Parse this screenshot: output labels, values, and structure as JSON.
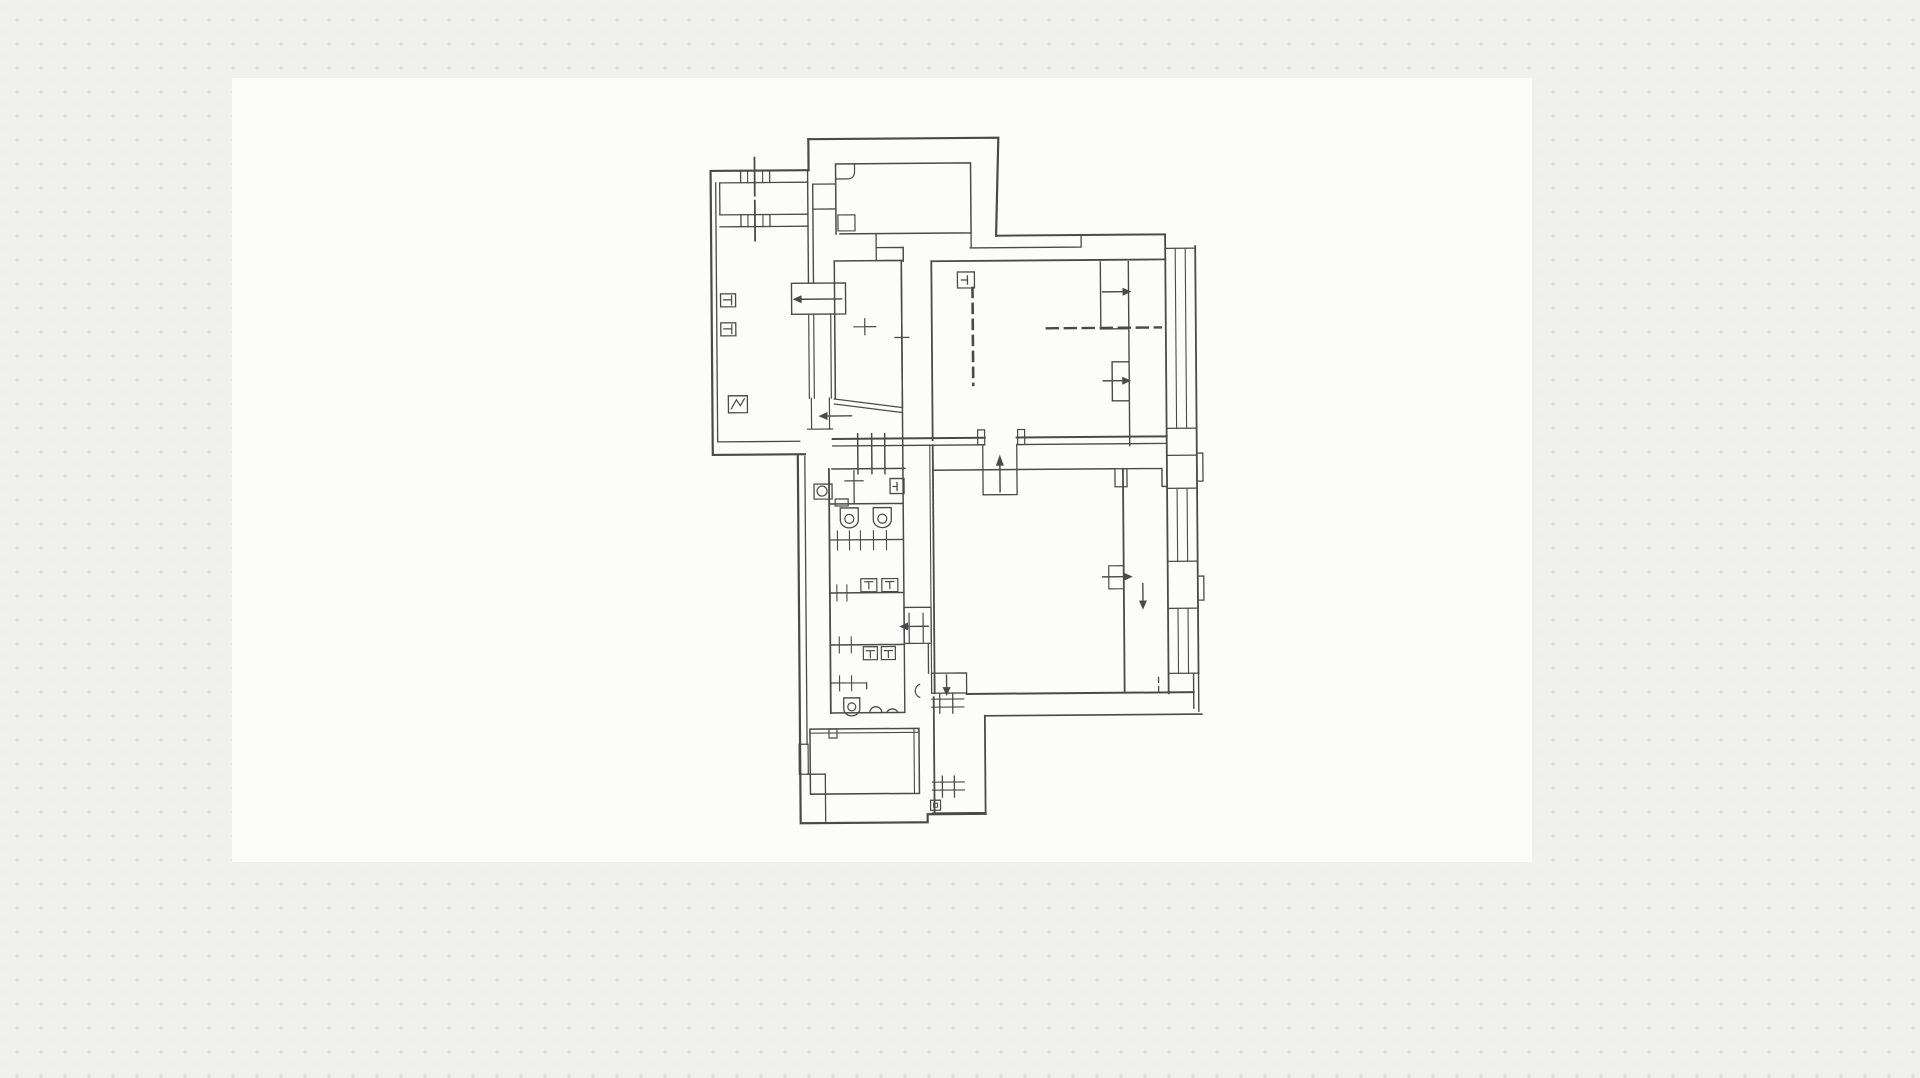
{
  "app": {
    "kind": "whiteboard-canvas-with-scanned-floor-plan",
    "visible_text": "none"
  },
  "canvas": {
    "background_color": "#f0f0ef",
    "dot_color": "#d9d9d9",
    "dot_faint_color": "#e9e9e8",
    "dot_spacing_px": 24
  },
  "scan_page": {
    "background_color": "#fcfcfb",
    "x": 232,
    "y": 78,
    "width": 1300,
    "height": 784
  },
  "floor_plan": {
    "line_color": "#4a4a4a",
    "type": "scanned architectural floor plan, single storey, no text labels",
    "orientation_skew_deg": -0.45,
    "rooms": [
      "left-wing-room",
      "entry-vestibule",
      "upper-inner-room",
      "upper-hall",
      "middle-room",
      "wc-block-top",
      "wc-block-middle",
      "wc-block-lower",
      "lower-hall",
      "bottom-room",
      "bottom-right-room",
      "east-corridor"
    ],
    "symbols": [
      {
        "name": "radiator-icon",
        "count": 2,
        "location": "left wing west wall"
      },
      {
        "name": "equipment-zigzag-icon",
        "count": 1,
        "location": "left wing south-west"
      },
      {
        "name": "window-tick-icon",
        "count": 4,
        "location": "left wing north wall and bottom-right room"
      },
      {
        "name": "door-arrow-left-icon",
        "count": 3,
        "location": "central corridor doors"
      },
      {
        "name": "door-arrow-up-icon",
        "count": 1,
        "location": "main hall entrance"
      },
      {
        "name": "door-arrow-down-icon",
        "count": 2,
        "location": "south doors"
      },
      {
        "name": "stair-arrow-right-icon",
        "count": 3,
        "location": "east stair / east doors"
      },
      {
        "name": "toilet-icon",
        "count": 3,
        "location": "wc block"
      },
      {
        "name": "urinal-arc-icon",
        "count": 2,
        "location": "wc block lower room"
      },
      {
        "name": "cistern-box-icon",
        "count": 4,
        "location": "wc block partitions"
      },
      {
        "name": "sink-icon",
        "count": 2,
        "location": "wc block"
      },
      {
        "name": "hatched-wall-segment",
        "count": 2,
        "location": "upper block and south-west wall"
      },
      {
        "name": "dashed-guide-line",
        "count": 2,
        "location": "upper hall"
      },
      {
        "name": "window-pier-strip",
        "count": 3,
        "location": "east facade"
      }
    ]
  }
}
